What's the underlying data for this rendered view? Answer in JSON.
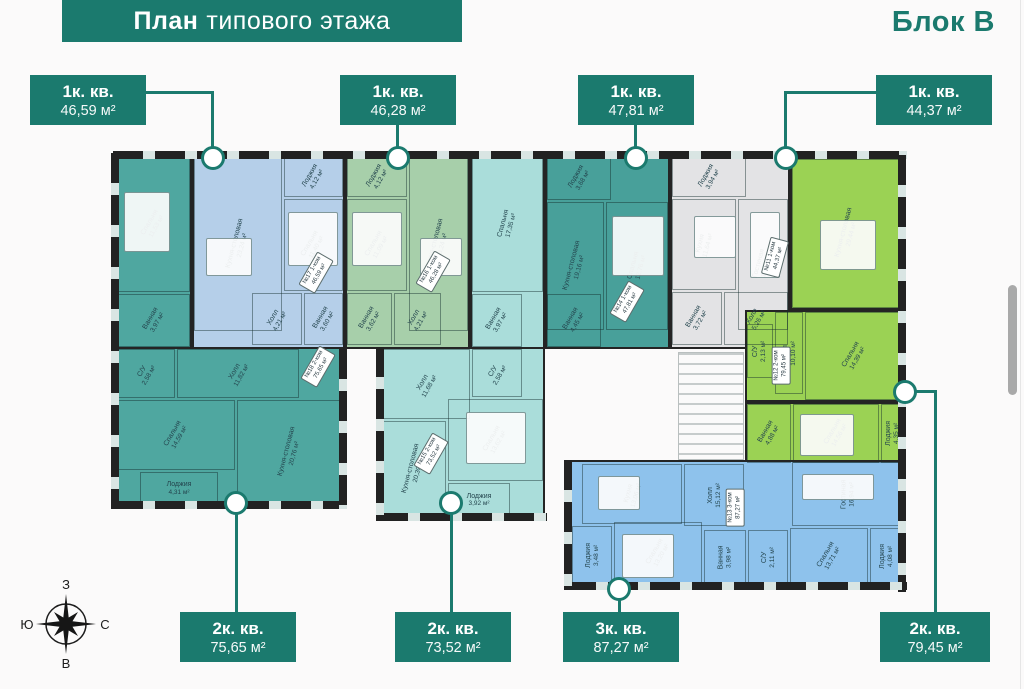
{
  "header": {
    "title_bold": "План",
    "title_rest": "типового этажа",
    "block_label": "Блок В"
  },
  "callouts": {
    "t1": {
      "type": "1к. кв.",
      "area": "46,59 м²"
    },
    "t2": {
      "type": "1к. кв.",
      "area": "46,28 м²"
    },
    "t3": {
      "type": "1к. кв.",
      "area": "47,81 м²"
    },
    "t4": {
      "type": "1к. кв.",
      "area": "44,37 м²"
    },
    "b1": {
      "type": "2к. кв.",
      "area": "75,65 м²"
    },
    "b2": {
      "type": "2к. кв.",
      "area": "73,52 м²"
    },
    "b3": {
      "type": "3к. кв.",
      "area": "87,27 м²"
    },
    "b4": {
      "type": "2к. кв.",
      "area": "79,45 м²"
    }
  },
  "apts": {
    "a18": {
      "unit": "№18",
      "type": "2-ком",
      "area": "75,65 м²",
      "rooms": {
        "bedroom1": {
          "name": "Спальня",
          "area": "11,53 м²"
        },
        "bath": {
          "name": "Ванная",
          "area": "3,97 м²"
        },
        "wc": {
          "name": "С/У",
          "area": "2,58 м²"
        },
        "hall": {
          "name": "Холл",
          "area": "11,82 м²"
        },
        "bedroom2": {
          "name": "Спальня",
          "area": "14,59 м²"
        },
        "loggia": {
          "name": "Лоджия",
          "area": "4,31 м²"
        },
        "kitchen": {
          "name": "Кухня-столовая",
          "area": "20,76 м²"
        }
      }
    },
    "a17": {
      "unit": "№17",
      "type": "1-ком",
      "area": "46,59 м²",
      "rooms": {
        "loggia": {
          "name": "Лоджия",
          "area": "4,12 м²"
        },
        "kitchen": {
          "name": "Кухня-столовая",
          "area": "23,24 м²"
        },
        "bedroom": {
          "name": "Спальня",
          "area": "11,40 м²"
        },
        "hall": {
          "name": "Холл",
          "area": "4,21 м²"
        },
        "bath": {
          "name": "Ванная",
          "area": "3,60 м²"
        }
      }
    },
    "a16": {
      "unit": "№16",
      "type": "1-ком",
      "area": "46,28 м²",
      "rooms": {
        "loggia": {
          "name": "Лоджия",
          "area": "4,12 м²"
        },
        "bedroom": {
          "name": "Спальня",
          "area": "11,09 м²"
        },
        "kitchen": {
          "name": "Кухня-столовая",
          "area": "23,24 м²"
        },
        "bath": {
          "name": "Ванная",
          "area": "3,62 м²"
        },
        "hall": {
          "name": "Холл",
          "area": "4,21 м²"
        }
      }
    },
    "a15": {
      "unit": "№15",
      "type": "2-ком",
      "area": "73,52 м²",
      "rooms": {
        "bedroom1": {
          "name": "Спальня",
          "area": "17,35 м²"
        },
        "bath": {
          "name": "Ванная",
          "area": "3,97 м²"
        },
        "hall": {
          "name": "Холл",
          "area": "11,68 м²"
        },
        "wc": {
          "name": "С/У",
          "area": "2,58 м²"
        },
        "kitchen": {
          "name": "Кухня-столовая",
          "area": "20,39 м²"
        },
        "bedroom2": {
          "name": "Спальня",
          "area": "13,62 м²"
        },
        "loggia": {
          "name": "Лоджия",
          "area": "3,92 м²"
        }
      }
    },
    "a14": {
      "unit": "№14",
      "type": "1-ком",
      "area": "47,81 м²",
      "rooms": {
        "loggia": {
          "name": "Лоджия",
          "area": "3,68 м²"
        },
        "kitchen": {
          "name": "Кухня-столовая",
          "area": "19,16 м²"
        },
        "bedroom": {
          "name": "Спальня",
          "area": "12,76 м²"
        },
        "bath": {
          "name": "Ванная",
          "area": "4,45 м²"
        }
      }
    },
    "a11": {
      "unit": "№11",
      "type": "1-ком",
      "area": "44,37 м²",
      "rooms": {
        "loggia": {
          "name": "Лоджия",
          "area": "3,94 м²"
        },
        "kitchen": {
          "name": "Кухня",
          "area": "11,64 м²"
        },
        "living": {
          "name": "Гостиная",
          "area": "19,82 м²"
        },
        "bath": {
          "name": "Ванная",
          "area": "3,72 м²"
        },
        "hall": {
          "name": "Холл",
          "area": "5,26 м²"
        }
      }
    },
    "a12": {
      "unit": "№12",
      "type": "2-ком",
      "area": "79,45 м²",
      "rooms": {
        "kitchen": {
          "name": "Кухня-столовая",
          "area": "29,44 м²"
        },
        "wc": {
          "name": "С/У",
          "area": "2,13 м²"
        },
        "hall": {
          "name": "Холл",
          "area": "10,10 м²"
        },
        "bedroom1": {
          "name": "Спальня",
          "area": "14,39 м²"
        },
        "bath": {
          "name": "Ванная",
          "area": "4,88 м²"
        },
        "bedroom2": {
          "name": "Спальня",
          "area": "14,56 м²"
        },
        "loggia": {
          "name": "Лоджия",
          "area": "4,35 м²"
        }
      }
    },
    "a13": {
      "unit": "№13",
      "type": "3-ком",
      "area": "87,27 м²",
      "rooms": {
        "kitchen": {
          "name": "Кухня",
          "area": "13,06 м²"
        },
        "hall": {
          "name": "Холл",
          "area": "15,12 м²"
        },
        "living": {
          "name": "Гостиная",
          "area": "16,94 м²"
        },
        "loggia1": {
          "name": "Лоджия",
          "area": "3,48 м²"
        },
        "bedroom1": {
          "name": "Спальня",
          "area": "13,20 м²"
        },
        "bath": {
          "name": "Ванная",
          "area": "3,98 м²"
        },
        "wc": {
          "name": "С/У",
          "area": "2,11 м²"
        },
        "bedroom2": {
          "name": "Спальня",
          "area": "13,71 м²"
        },
        "loggia2": {
          "name": "Лоджия",
          "area": "4,08 м²"
        }
      }
    }
  },
  "compass": {
    "top": "З",
    "left": "Ю",
    "right": "С",
    "bottom": "В"
  },
  "colors": {
    "accent": "#1b7a6e",
    "wall": "#242424",
    "apt18": "#4fa7a0",
    "apt17": "#b5cfe9",
    "apt16": "#a7cfaa",
    "apt15": "#aaddda",
    "apt14": "#48a09a",
    "apt11": "#e3e3e5",
    "apt12": "#9bd254",
    "apt13": "#8ec2ec",
    "scrollbar": "#a9a9a9"
  }
}
